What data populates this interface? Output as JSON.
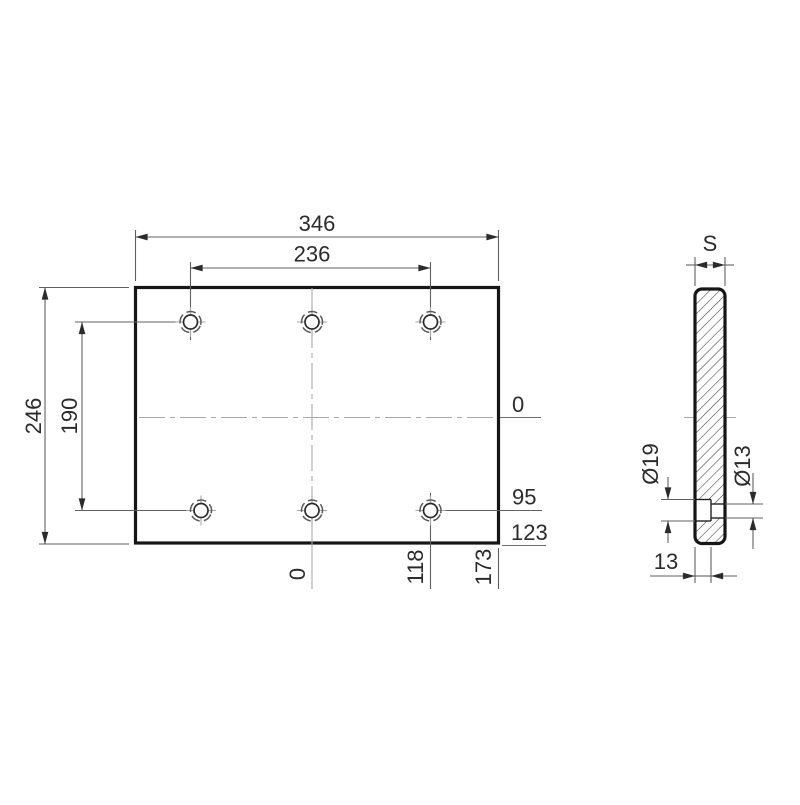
{
  "front_view": {
    "overall_width": "346",
    "hole_spacing_x": "236",
    "overall_height": "246",
    "hole_spacing_y": "190",
    "ordinates_right": [
      {
        "label": "0"
      },
      {
        "label": "95"
      },
      {
        "label": "123"
      }
    ],
    "ordinates_bottom": [
      {
        "label": "0"
      },
      {
        "label": "118"
      },
      {
        "label": "173"
      }
    ]
  },
  "side_view": {
    "thickness_label": "S",
    "counterbore_diameter": "Ø19",
    "hole_diameter": "Ø13",
    "counterbore_depth": "13"
  },
  "colors": {
    "background": "#ffffff",
    "outline": "#161616",
    "dimension_lines": "#606060",
    "centerlines": "#a8a8a8",
    "text": "#2b2b2b"
  }
}
